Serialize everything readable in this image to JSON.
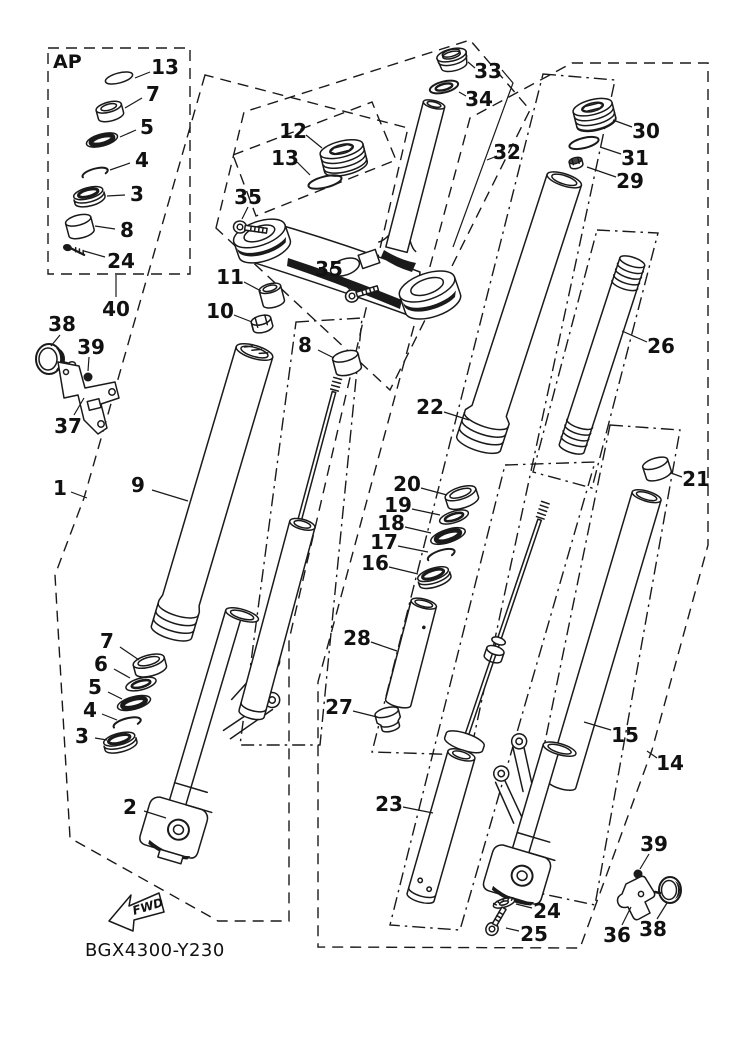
{
  "diagram": {
    "drawing_code": "BGX4300-Y230",
    "orientation_label": "FWD",
    "inset_label": "AP",
    "colors": {
      "line": "#1a1a1a",
      "background": "#ffffff"
    },
    "callouts": [
      {
        "text": "13",
        "x": 165,
        "y": 67,
        "leader": [
          150,
          72,
          135,
          78
        ]
      },
      {
        "text": "7",
        "x": 153,
        "y": 94,
        "leader": [
          142,
          98,
          125,
          108
        ]
      },
      {
        "text": "5",
        "x": 147,
        "y": 127,
        "leader": [
          136,
          130,
          120,
          137
        ]
      },
      {
        "text": "4",
        "x": 142,
        "y": 160,
        "leader": [
          130,
          163,
          110,
          170
        ]
      },
      {
        "text": "3",
        "x": 137,
        "y": 194,
        "leader": [
          125,
          195,
          107,
          196
        ]
      },
      {
        "text": "8",
        "x": 127,
        "y": 230,
        "leader": [
          115,
          229,
          95,
          226
        ]
      },
      {
        "text": "24",
        "x": 121,
        "y": 261,
        "leader": [
          105,
          257,
          84,
          251
        ]
      },
      {
        "text": "40",
        "x": 116,
        "y": 309,
        "leader": [
          116,
          297,
          116,
          275
        ]
      },
      {
        "text": "38",
        "x": 62,
        "y": 324,
        "leader": [
          60,
          335,
          51,
          346
        ]
      },
      {
        "text": "39",
        "x": 91,
        "y": 347,
        "leader": [
          89,
          357,
          88,
          371
        ]
      },
      {
        "text": "37",
        "x": 68,
        "y": 426,
        "leader": [
          74,
          415,
          84,
          398
        ]
      },
      {
        "text": "1",
        "x": 60,
        "y": 488,
        "leader": [
          71,
          492,
          87,
          498
        ]
      },
      {
        "text": "9",
        "x": 138,
        "y": 485,
        "leader": [
          152,
          490,
          188,
          501
        ]
      },
      {
        "text": "11",
        "x": 230,
        "y": 277,
        "leader": [
          244,
          282,
          261,
          291
        ]
      },
      {
        "text": "10",
        "x": 220,
        "y": 311,
        "leader": [
          234,
          315,
          252,
          322
        ]
      },
      {
        "text": "8",
        "x": 305,
        "y": 345,
        "leader": [
          318,
          350,
          334,
          358
        ]
      },
      {
        "text": "12",
        "x": 293,
        "y": 131,
        "leader": [
          306,
          135,
          322,
          148
        ]
      },
      {
        "text": "13",
        "x": 285,
        "y": 158,
        "leader": [
          297,
          162,
          310,
          175
        ]
      },
      {
        "text": "35",
        "x": 248,
        "y": 197,
        "leader": [
          248,
          207,
          242,
          219
        ]
      },
      {
        "text": "35",
        "x": 329,
        "y": 269,
        "leader": [
          338,
          277,
          350,
          290
        ]
      },
      {
        "text": "33",
        "x": 488,
        "y": 71,
        "leader": [
          475,
          68,
          468,
          62
        ]
      },
      {
        "text": "34",
        "x": 479,
        "y": 99,
        "leader": [
          466,
          96,
          459,
          92
        ]
      },
      {
        "text": "32",
        "x": 507,
        "y": 152,
        "leader": [
          497,
          156,
          487,
          160
        ]
      },
      {
        "text": "30",
        "x": 646,
        "y": 131,
        "leader": [
          632,
          127,
          613,
          120
        ]
      },
      {
        "text": "31",
        "x": 635,
        "y": 158,
        "leader": [
          621,
          154,
          600,
          147
        ]
      },
      {
        "text": "29",
        "x": 630,
        "y": 181,
        "leader": [
          616,
          177,
          587,
          167
        ]
      },
      {
        "text": "26",
        "x": 661,
        "y": 346,
        "leader": [
          647,
          342,
          622,
          331
        ]
      },
      {
        "text": "22",
        "x": 430,
        "y": 407,
        "leader": [
          444,
          412,
          469,
          420
        ]
      },
      {
        "text": "20",
        "x": 407,
        "y": 484,
        "leader": [
          421,
          488,
          447,
          495
        ]
      },
      {
        "text": "19",
        "x": 398,
        "y": 505,
        "leader": [
          412,
          509,
          440,
          515
        ]
      },
      {
        "text": "18",
        "x": 391,
        "y": 523,
        "leader": [
          405,
          527,
          431,
          533
        ]
      },
      {
        "text": "17",
        "x": 384,
        "y": 542,
        "leader": [
          398,
          546,
          428,
          552
        ]
      },
      {
        "text": "16",
        "x": 375,
        "y": 563,
        "leader": [
          389,
          567,
          418,
          574
        ]
      },
      {
        "text": "28",
        "x": 357,
        "y": 638,
        "leader": [
          371,
          642,
          397,
          651
        ]
      },
      {
        "text": "27",
        "x": 339,
        "y": 707,
        "leader": [
          353,
          711,
          377,
          717
        ]
      },
      {
        "text": "21",
        "x": 696,
        "y": 479,
        "leader": [
          682,
          477,
          671,
          473
        ]
      },
      {
        "text": "15",
        "x": 625,
        "y": 735,
        "leader": [
          611,
          730,
          584,
          722
        ]
      },
      {
        "text": "14",
        "x": 670,
        "y": 763,
        "leader": [
          657,
          758,
          647,
          751
        ]
      },
      {
        "text": "23",
        "x": 389,
        "y": 804,
        "leader": [
          403,
          807,
          433,
          813
        ]
      },
      {
        "text": "24",
        "x": 547,
        "y": 911,
        "leader": [
          532,
          908,
          516,
          904
        ]
      },
      {
        "text": "25",
        "x": 534,
        "y": 934,
        "leader": [
          519,
          931,
          506,
          928
        ]
      },
      {
        "text": "36",
        "x": 617,
        "y": 935,
        "leader": [
          622,
          925,
          631,
          907
        ]
      },
      {
        "text": "38",
        "x": 653,
        "y": 929,
        "leader": [
          657,
          919,
          667,
          903
        ]
      },
      {
        "text": "39",
        "x": 654,
        "y": 844,
        "leader": [
          649,
          854,
          640,
          869
        ]
      },
      {
        "text": "7",
        "x": 107,
        "y": 641,
        "leader": [
          120,
          647,
          139,
          660
        ]
      },
      {
        "text": "6",
        "x": 101,
        "y": 664,
        "leader": [
          114,
          669,
          130,
          678
        ]
      },
      {
        "text": "5",
        "x": 95,
        "y": 687,
        "leader": [
          108,
          692,
          122,
          699
        ]
      },
      {
        "text": "4",
        "x": 90,
        "y": 710,
        "leader": [
          102,
          714,
          117,
          720
        ]
      },
      {
        "text": "3",
        "x": 82,
        "y": 736,
        "leader": [
          95,
          738,
          107,
          740
        ]
      },
      {
        "text": "2",
        "x": 130,
        "y": 807,
        "leader": [
          144,
          811,
          166,
          818
        ]
      }
    ],
    "extra_leader_lines": [
      [
        502,
        70,
        513,
        83,
        453,
        247
      ]
    ]
  }
}
